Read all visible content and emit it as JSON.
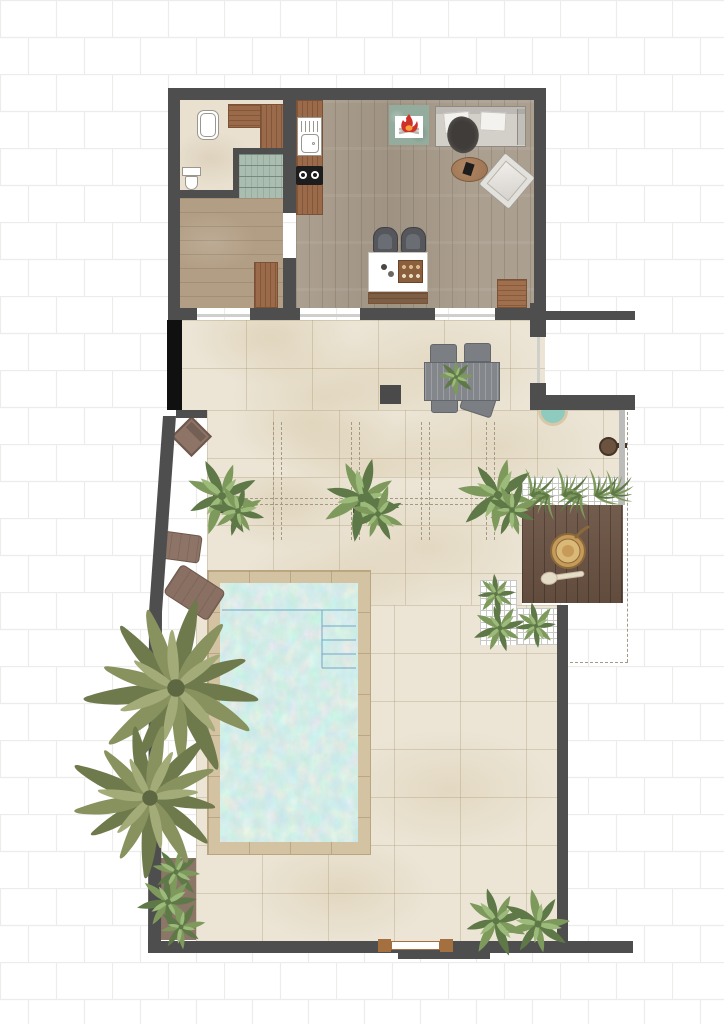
{
  "plan": {
    "type": "villa-floor-plan",
    "areas": [
      "bathroom",
      "bedroom",
      "kitchen",
      "living-room",
      "terrace",
      "pergola-patio",
      "swimming-pool",
      "wood-deck",
      "outdoor-shower",
      "garden"
    ],
    "furniture": [
      "bathtub",
      "toilet",
      "staircase",
      "wardrobe",
      "kitchen-sink",
      "cooktop",
      "fireplace",
      "sofa",
      "coffee-table",
      "armchair",
      "bar-island",
      "bar-stools",
      "door-mat",
      "dining-table",
      "dining-chairs",
      "lounge-chair",
      "sun-cushions",
      "planters",
      "palm-trees",
      "sauna-bucket",
      "ladle",
      "shrubs",
      "entry-gate",
      "shower-head"
    ]
  },
  "palette": {
    "wall": "#4e4e4e",
    "pillar": "#101010",
    "glass": "#cfcfcc",
    "brick_line": "#ececea",
    "bath_floor": "#e9e0d0",
    "wood_left": "#b29e84",
    "wood_main": "#a79a89",
    "wood_accent": "#9a6a4a",
    "wood_accent_dark": "#7c5236",
    "stairs": "#a9bdb0",
    "stairs_line": "#76897c",
    "patio": "#ece5d6",
    "patio_joint": "#cbbd9f",
    "coping": "#d4c3a2",
    "coping_line": "#b9a67f",
    "water_line": "#6fa8c8",
    "deck": "#6a5242",
    "deck_line": "#55402f",
    "fence": "#bcbcba",
    "lattice": "#ffffff",
    "lattice_line": "#c8c8c5",
    "plant_dark": "#5e7947",
    "plant_mid": "#7d9a5c",
    "plant_light": "#9cba79",
    "palm_dark": "#6e7a4c",
    "palm_mid": "#87925f",
    "palm_light": "#a3ab78",
    "palm_core": "#5d6742",
    "cushion": "#8d7466",
    "cushion_dark": "#6e584c",
    "sofa": "#d3d0ca",
    "sofa_edge": "#8f8b84",
    "throw": "#3f3c3a",
    "pillow": "#f4f2ee",
    "table_wood": "#9b7351",
    "table_wood_edge": "#7c5a3e",
    "chair_gray": "#7b7e82",
    "chair_edge": "#63666a",
    "table_gray": "#83868a",
    "stool": "#55575c",
    "stool_seat": "#6a6d73",
    "island": "#ffffff",
    "island_edge": "#c7c4be",
    "crate": "#8a5f3e",
    "crate_edge": "#6b4527",
    "mat": "#a06f4e",
    "fire_frame": "#93ac9d",
    "fire_red": "#d03028",
    "fire_orange": "#f2a43a",
    "log": "#b9b4ac",
    "shower_teal": "#8fcabe",
    "shower_ring": "#d8c8a8",
    "shower_head": "#6b5340",
    "shower_arm": "#443527",
    "bucket": "#c69a58",
    "bucket_dark": "#8a6a3c",
    "bucket_light": "#dab877",
    "ladle": "#e6ddc8",
    "ladle_edge": "#c4b89e",
    "white_fixture": "#ffffff",
    "fixture_edge": "#9b978f",
    "cooktop": "#1d1d1d",
    "dash": "#a49a84",
    "planter_box": "#4e4a41",
    "planter_bed": "#8b7668",
    "gate_post": "#a5703f",
    "dark_square": "#4a4a4a"
  }
}
